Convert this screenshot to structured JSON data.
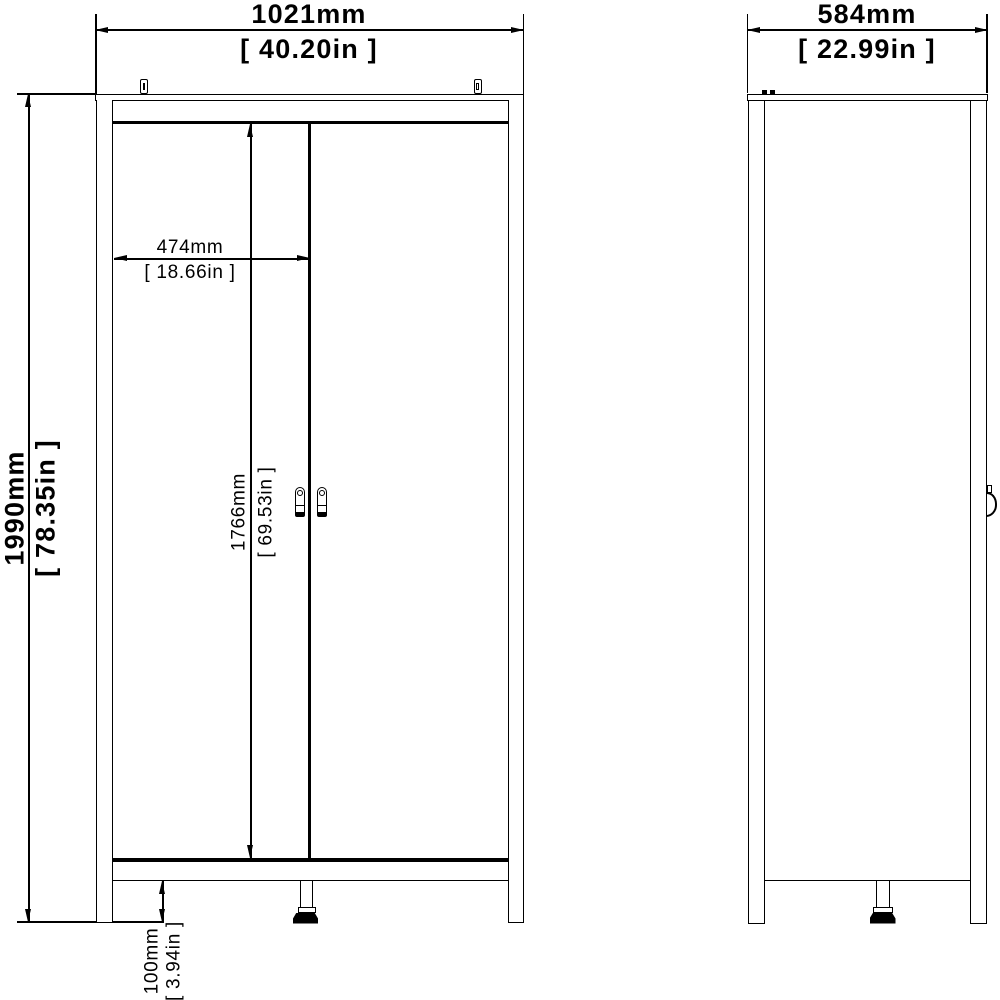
{
  "drawing": {
    "type": "furniture dimension diagram",
    "subject": "two-door wardrobe, front and side elevations",
    "background": "#ffffff",
    "line_color": "#000000"
  },
  "front_view": {
    "width": {
      "mm": "1021mm",
      "inches": "[ 40.20in ]"
    },
    "height": {
      "mm": "1990mm",
      "inches": "[ 78.35in ]"
    },
    "door_width": {
      "mm": "474mm",
      "inches": "[ 18.66in ]"
    },
    "door_height": {
      "mm": "1766mm",
      "inches": "[ 69.53in ]"
    },
    "leg_height": {
      "mm": "100mm",
      "inches": "[ 3.94in ]"
    }
  },
  "side_view": {
    "depth": {
      "mm": "584mm",
      "inches": "[ 22.99in ]"
    }
  }
}
